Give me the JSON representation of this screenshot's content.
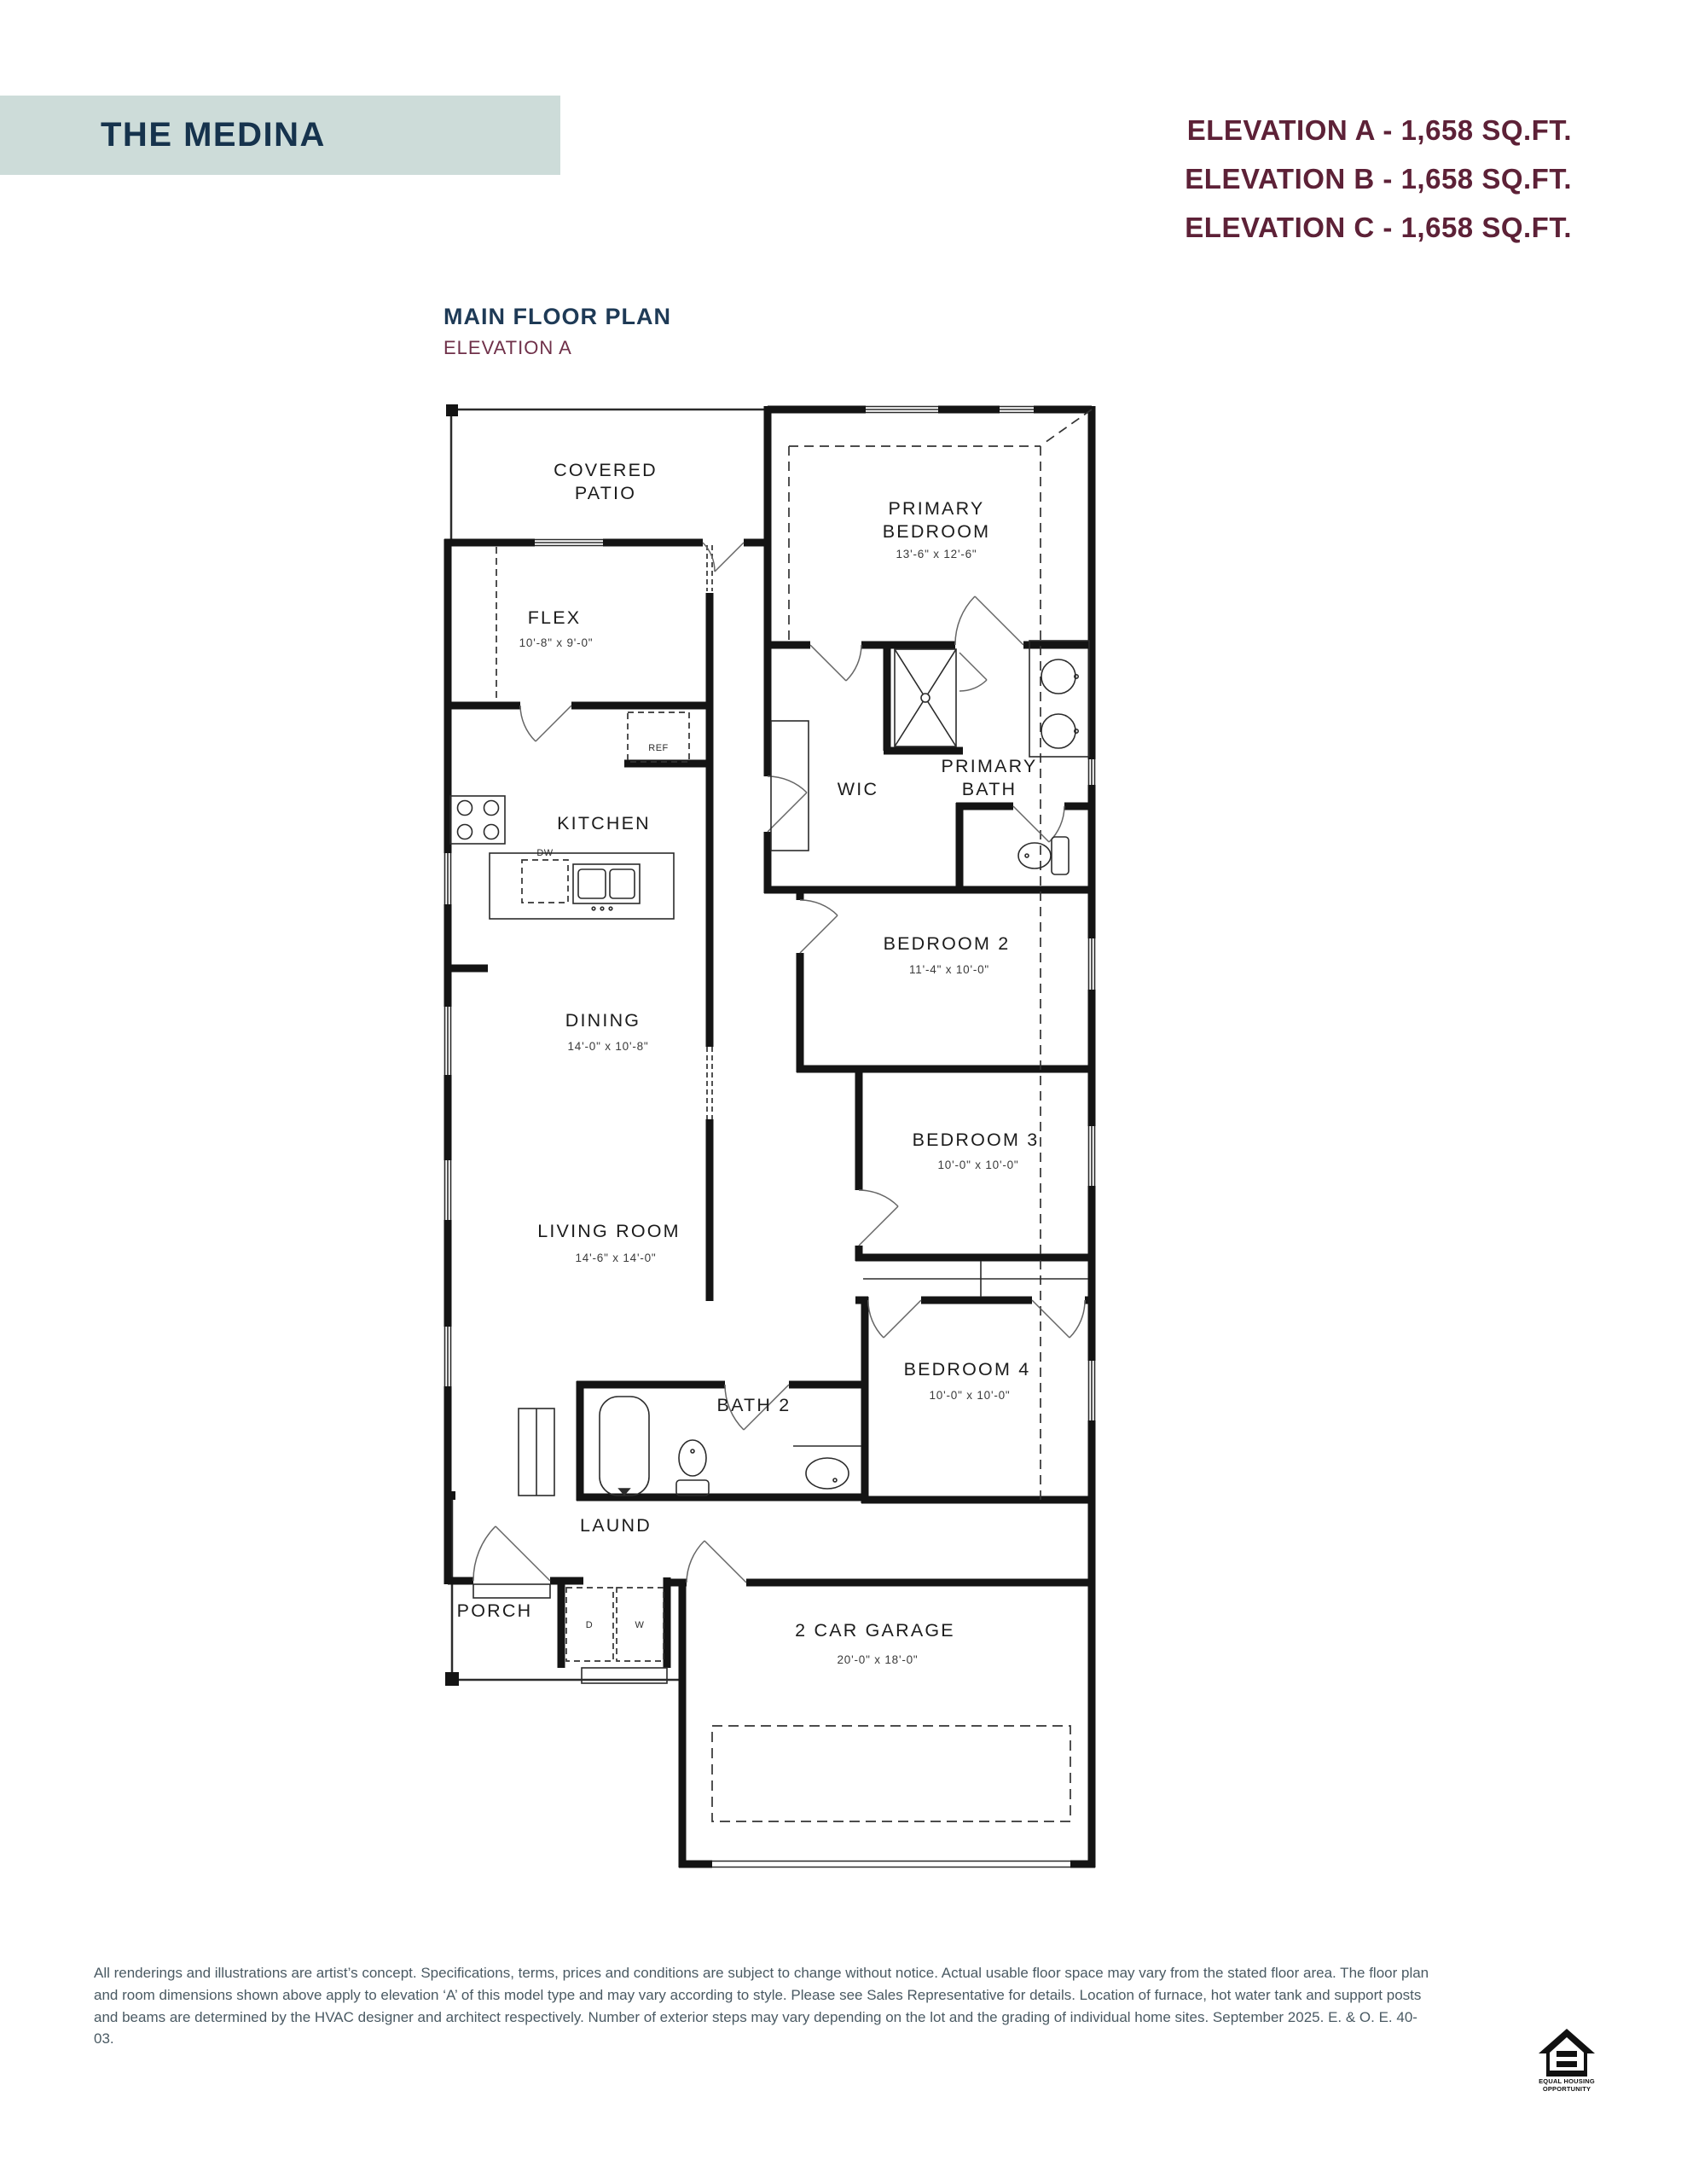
{
  "header": {
    "title": "THE MEDINA",
    "elevation_a": "ELEVATION A - 1,658 SQ.FT.",
    "elevation_b": "ELEVATION B - 1,658 SQ.FT.",
    "elevation_c": "ELEVATION C - 1,658 SQ.FT."
  },
  "plan_heading": {
    "title": "MAIN FLOOR PLAN",
    "subtitle": "ELEVATION A"
  },
  "rooms": {
    "covered_patio_1": "COVERED",
    "covered_patio_2": "PATIO",
    "primary_bedroom_1": "PRIMARY",
    "primary_bedroom_2": "BEDROOM",
    "primary_bedroom_dims": "13'-6\" x 12'-6\"",
    "flex": "FLEX",
    "flex_dims": "10'-8\" x 9'-0\"",
    "wic": "WIC",
    "primary_bath_1": "PRIMARY",
    "primary_bath_2": "BATH",
    "kitchen": "KITCHEN",
    "bedroom2": "BEDROOM 2",
    "bedroom2_dims": "11'-4\" x 10'-0\"",
    "dining": "DINING",
    "dining_dims": "14'-0\" x 10'-8\"",
    "bedroom3": "BEDROOM 3",
    "bedroom3_dims": "10'-0\" x 10'-0\"",
    "living": "LIVING ROOM",
    "living_dims": "14'-6\" x 14'-0\"",
    "bedroom4": "BEDROOM 4",
    "bedroom4_dims": "10'-0\" x 10'-0\"",
    "bath2": "BATH 2",
    "laund": "LAUND",
    "porch": "PORCH",
    "garage": "2 CAR GARAGE",
    "garage_dims": "20'-0\" x 18'-0\""
  },
  "fixtures": {
    "ref": "REF",
    "dw": "DW",
    "dryer": "D",
    "washer": "W"
  },
  "footer": {
    "disclaimer": "All renderings and illustrations are artist’s concept. Specifications, terms, prices and conditions are subject to change without notice. Actual usable floor space may vary from the stated floor area. The floor plan and room dimensions shown above apply to elevation ‘A’ of this model type and may vary according to style. Please see Sales Representative for details. Location of furnace, hot water tank and support posts and beams are determined by the HVAC designer and architect respectively. Number of exterior steps may vary depending on the lot and the grading of individual home sites. September 2025. E. & O. E. 40-03.",
    "eho_line1": "EQUAL HOUSING",
    "eho_line2": "OPPORTUNITY"
  },
  "colors": {
    "title_box": "#cddcd9",
    "title_text": "#16334d",
    "elevation_text": "#5d2137",
    "subtitle_text": "#6f3049",
    "footer_text": "#4a5a63",
    "wall": "#141414"
  }
}
